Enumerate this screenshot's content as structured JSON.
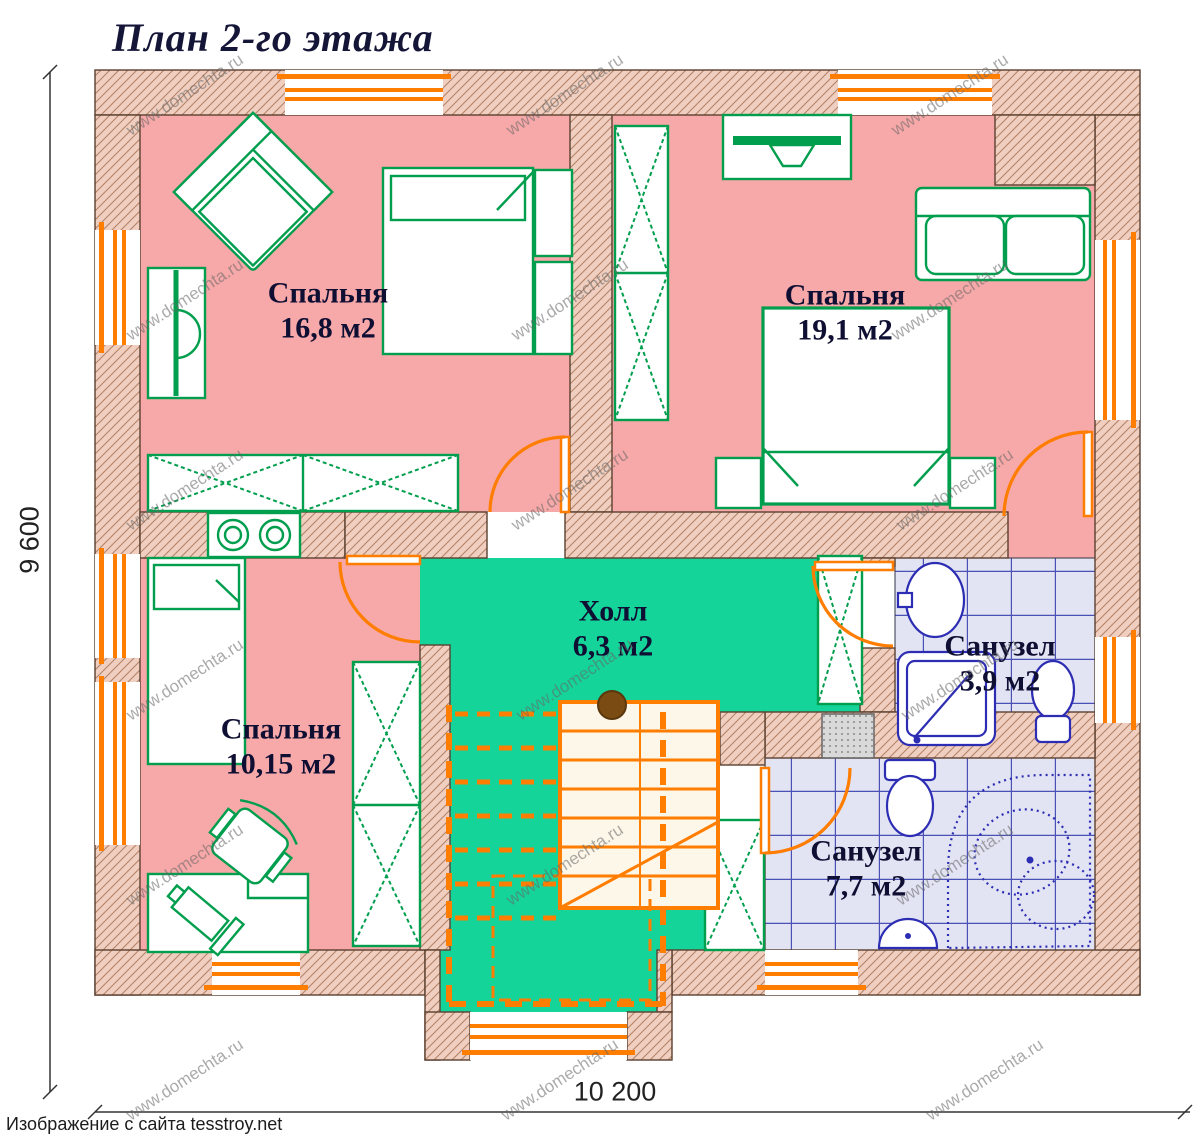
{
  "title": "План 2-го этажа",
  "caption": "Изображение с сайта tesstroy.net",
  "watermark": "www.domechta.ru",
  "dimensions": {
    "height": "9 600",
    "width": "10 200"
  },
  "rooms": [
    {
      "id": "bedroom-1",
      "name": "Спальня",
      "area": "16,8 м2"
    },
    {
      "id": "bedroom-2",
      "name": "Спальня",
      "area": "19,1 м2"
    },
    {
      "id": "bedroom-3",
      "name": "Спальня",
      "area": "10,15 м2"
    },
    {
      "id": "hall",
      "name": "Холл",
      "area": "6,3 м2"
    },
    {
      "id": "bathroom-small",
      "name": "Санузел",
      "area": "3,9 м2"
    },
    {
      "id": "bathroom-large",
      "name": "Санузел",
      "area": "7,7 м2"
    }
  ],
  "colors": {
    "floor_bedroom": "#f7a8a8",
    "floor_hall": "#15d49a",
    "floor_bathroom_tile": "#e2e4f4",
    "tile_grid": "#4a50b4",
    "wall_fill": "#f0cfc0",
    "wall_hatch": "#b5846a",
    "furniture_green": "#009e4d",
    "fixture_blue": "#2d2db4",
    "doors_windows_orange": "#ff7d00",
    "title_text": "#151538"
  }
}
